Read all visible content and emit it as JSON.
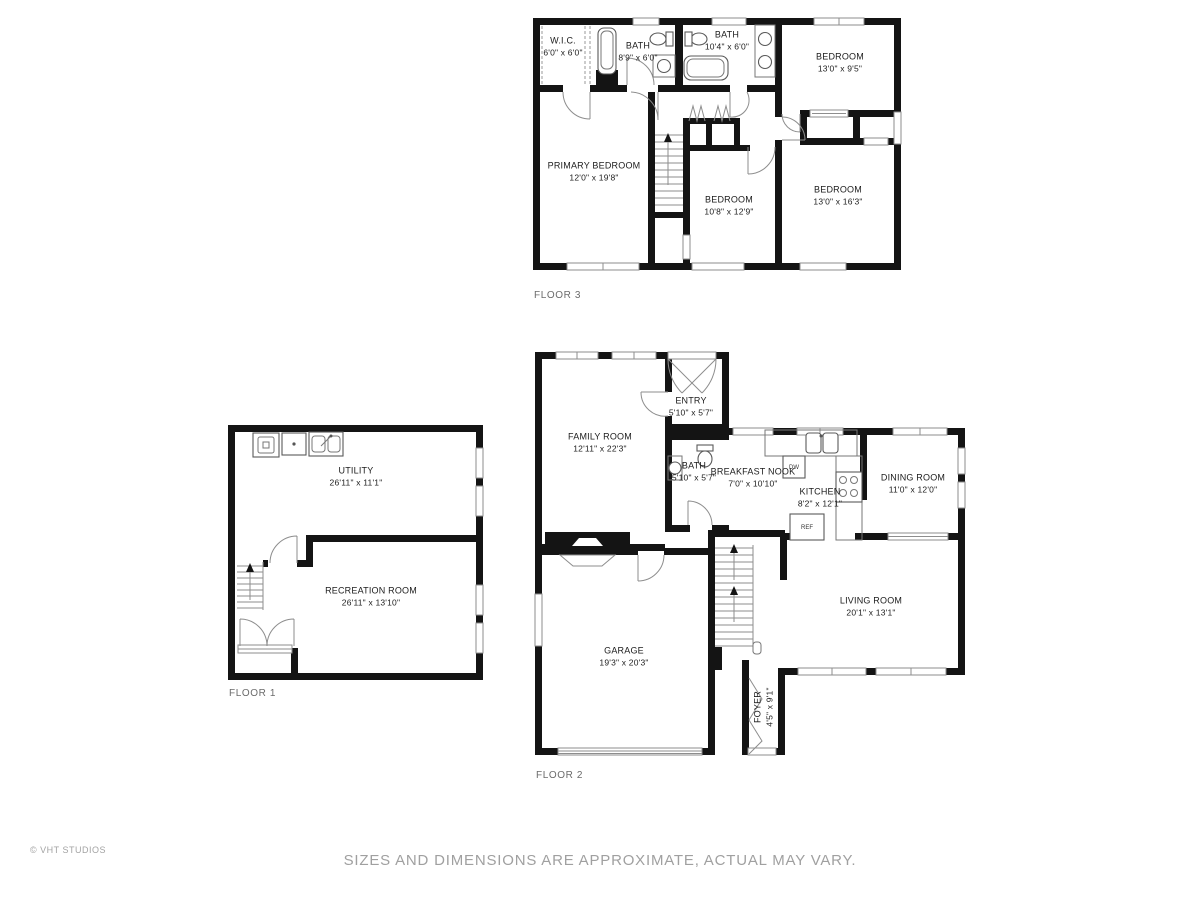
{
  "footer": {
    "copyright": "© VHT STUDIOS",
    "disclaimer": "SIZES AND DIMENSIONS ARE APPROXIMATE, ACTUAL MAY VARY."
  },
  "appliances": {
    "dishwasher": "DW",
    "refrigerator": "REF"
  },
  "floors": {
    "floor3": {
      "label": "FLOOR 3",
      "rooms": {
        "wic": {
          "name": "W.I.C.",
          "dims": "6'0\" x 6'0\""
        },
        "bath_a": {
          "name": "BATH",
          "dims": "8'9\" x 6'0\""
        },
        "bath_b": {
          "name": "BATH",
          "dims": "10'4\" x 6'0\""
        },
        "bedroom_tr": {
          "name": "BEDROOM",
          "dims": "13'0\" x 9'5\""
        },
        "primary": {
          "name": "PRIMARY BEDROOM",
          "dims": "12'0\" x 19'8\""
        },
        "bedroom_m": {
          "name": "BEDROOM",
          "dims": "10'8\" x 12'9\""
        },
        "bedroom_r": {
          "name": "BEDROOM",
          "dims": "13'0\" x 16'3\""
        }
      }
    },
    "floor1": {
      "label": "FLOOR 1",
      "rooms": {
        "utility": {
          "name": "UTILITY",
          "dims": "26'11\" x 11'1\""
        },
        "recreation": {
          "name": "RECREATION ROOM",
          "dims": "26'11\" x 13'10\""
        }
      }
    },
    "floor2": {
      "label": "FLOOR 2",
      "rooms": {
        "family": {
          "name": "FAMILY ROOM",
          "dims": "12'11\" x 22'3\""
        },
        "entry": {
          "name": "ENTRY",
          "dims": "5'10\" x 5'7\""
        },
        "bath": {
          "name": "BATH",
          "dims": "5'10\" x 5'7\""
        },
        "nook": {
          "name": "BREAKFAST NOOK",
          "dims": "7'0\" x 10'10\""
        },
        "kitchen": {
          "name": "KITCHEN",
          "dims": "8'2\" x 12'1\""
        },
        "dining": {
          "name": "DINING ROOM",
          "dims": "11'0\" x 12'0\""
        },
        "living": {
          "name": "LIVING ROOM",
          "dims": "20'1\" x 13'1\""
        },
        "garage": {
          "name": "GARAGE",
          "dims": "19'3\" x 20'3\""
        },
        "foyer": {
          "name": "FOYER",
          "dims": "4'5\" x 9'1\""
        }
      }
    }
  }
}
